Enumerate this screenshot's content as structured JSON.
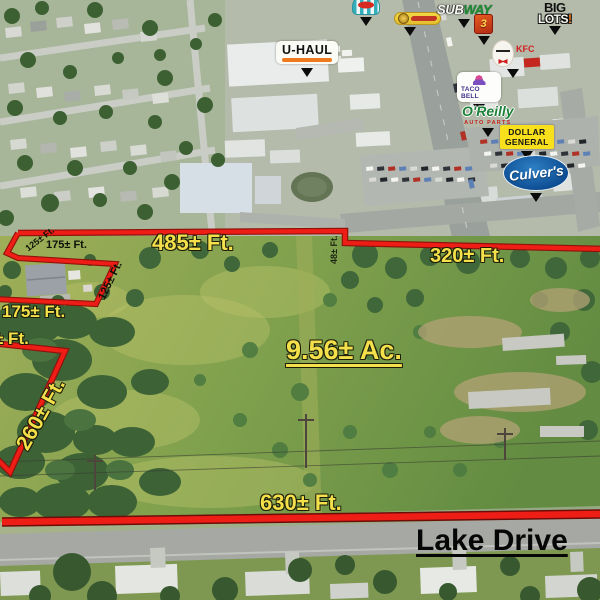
{
  "annotation_colors": {
    "boundary_red": "#ee1d15",
    "label_yellow": "#f4e04a",
    "label_black": "#0d1207"
  },
  "parcel": {
    "area": "9.56± Ac.",
    "street": "Lake Drive"
  },
  "measurements": {
    "top_left_edge": "485± Ft.",
    "top_right_edge": "320± Ft.",
    "jog_edge": "48± Ft.",
    "cutout_top_edge": "175± Ft.",
    "cutout_upper_left_edge": "125± Ft.",
    "cutout_right_edge": "125± Ft.",
    "cutout_bottom_edge": "175± Ft.",
    "left_partial_edge": "± Ft.",
    "left_diagonal_edge": "260± Ft.",
    "bottom_edge": "630± Ft."
  },
  "businesses": {
    "uhaul": {
      "label": "U-HAUL"
    },
    "subway": {
      "part1": "SUB",
      "part2": "WAY"
    },
    "big_lots": {
      "line1": "BIG",
      "line2": "LOTS",
      "exclaim": "!"
    },
    "kfc": {
      "label": "KFC"
    },
    "taco_bell": {
      "label": "TACO BELL"
    },
    "oreilly": {
      "label": "O'Reilly",
      "sublabel": "AUTO PARTS"
    },
    "dollar_general": {
      "line1": "DOLLAR",
      "line2": "GENERAL"
    },
    "culvers": {
      "label": "Culver's"
    },
    "orange_store": {
      "label": "3"
    }
  }
}
